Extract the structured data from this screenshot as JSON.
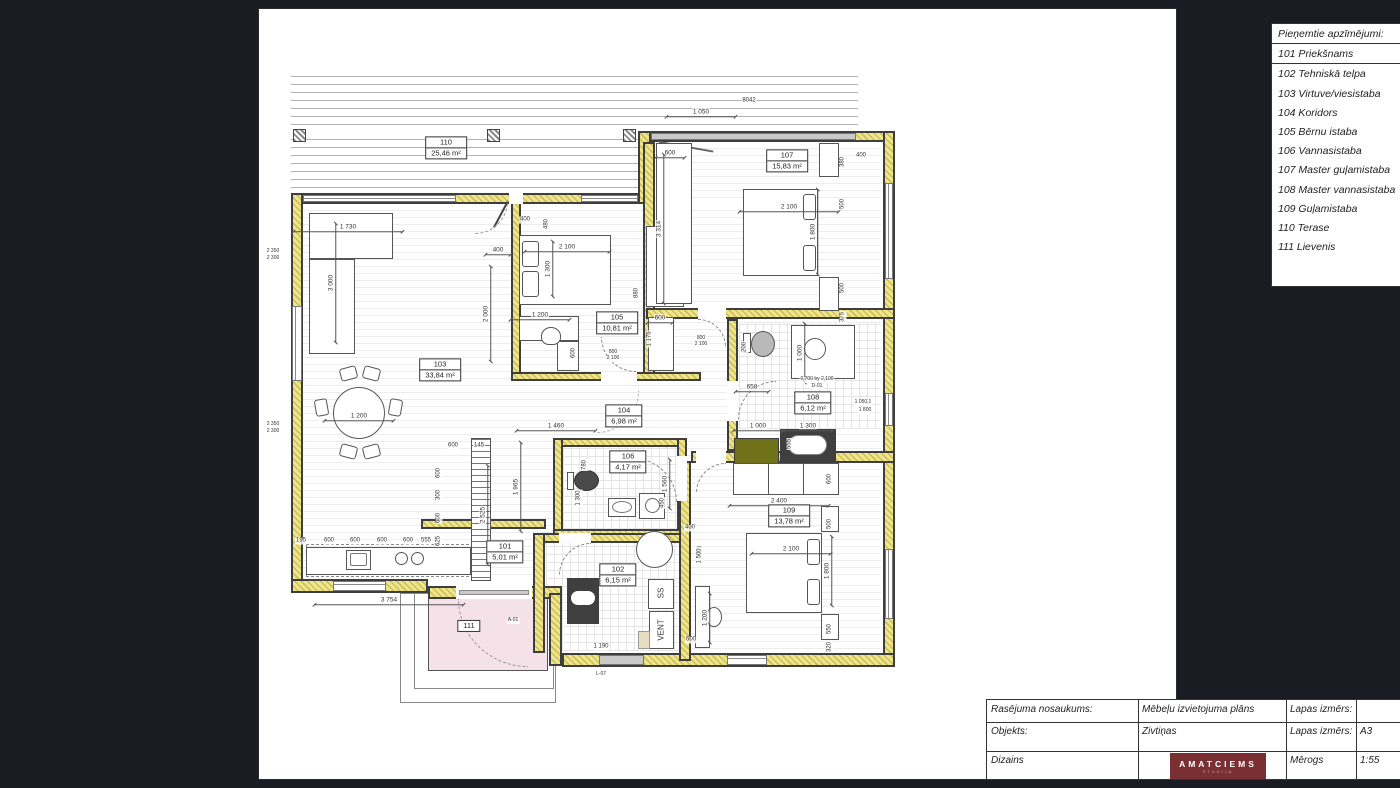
{
  "legend": {
    "title": "Pieņemtie apzīmējumi:",
    "items": [
      {
        "num": "101",
        "name": "Priekšnams"
      },
      {
        "num": "102",
        "name": "Tehniskā telpa"
      },
      {
        "num": "103",
        "name": "Virtuve/viesistaba"
      },
      {
        "num": "104",
        "name": "Koridors"
      },
      {
        "num": "105",
        "name": "Bērnu istaba"
      },
      {
        "num": "106",
        "name": "Vannasistaba"
      },
      {
        "num": "107",
        "name": "Master guļamistaba"
      },
      {
        "num": "108",
        "name": "Master vannasistaba"
      },
      {
        "num": "109",
        "name": "Guļamistaba"
      },
      {
        "num": "110",
        "name": "Terase"
      },
      {
        "num": "111",
        "name": "Lievenis"
      }
    ]
  },
  "title_block": {
    "rows": [
      {
        "label": "Rasējuma nosaukums:",
        "value": "Mēbeļu izvietojuma plāns",
        "label2": "Lapas izmērs:",
        "value2": ""
      },
      {
        "label": "Objekts:",
        "value": "Zivtiņas",
        "label2": "Lapas izmērs:",
        "value2": "A3"
      },
      {
        "label": "Dizains",
        "value": "",
        "label2": "Mērogs",
        "value2": "1:55"
      }
    ],
    "logo": {
      "text": "AMATCIEMS",
      "subtext": "STUDIJA"
    }
  },
  "plan": {
    "colors": {
      "insulation": "#efe58d",
      "wall": "#3e3e3e",
      "porch_pink": "#f5e1e8",
      "logo_maroon": "#7a2f33",
      "counter_dark": "#3f3f3f",
      "cabinet_olive": "#6f7218"
    },
    "rooms": [
      {
        "num": "110",
        "area": "25,46 m²",
        "x": 445,
        "y": 147
      },
      {
        "num": "103",
        "area": "33,84 m²",
        "x": 439,
        "y": 369
      },
      {
        "num": "105",
        "area": "10,81 m²",
        "x": 616,
        "y": 322
      },
      {
        "num": "107",
        "area": "15,83 m²",
        "x": 786,
        "y": 160
      },
      {
        "num": "104",
        "area": "6,98 m²",
        "x": 623,
        "y": 415
      },
      {
        "num": "106",
        "area": "4,17 m²",
        "x": 627,
        "y": 461
      },
      {
        "num": "108",
        "area": "6,12 m²",
        "x": 812,
        "y": 402
      },
      {
        "num": "101",
        "area": "5,01 m²",
        "x": 504,
        "y": 551
      },
      {
        "num": "102",
        "area": "6,15 m²",
        "x": 617,
        "y": 574
      },
      {
        "num": "109",
        "area": "13,78 m²",
        "x": 788,
        "y": 515
      },
      {
        "num": "111",
        "area": "",
        "x": 468,
        "y": 625
      }
    ],
    "dims": [
      {
        "t": "1 050",
        "x": 700,
        "y": 112,
        "w": 70
      },
      {
        "t": "8042",
        "x": 748,
        "y": 100,
        "s": 6
      },
      {
        "t": "600",
        "x": 669,
        "y": 153,
        "w": 30
      },
      {
        "t": "3 314",
        "x": 659,
        "y": 228,
        "r": -90,
        "w": 150
      },
      {
        "t": "2 100",
        "x": 788,
        "y": 207,
        "w": 100
      },
      {
        "t": "1 800",
        "x": 813,
        "y": 231,
        "r": -90,
        "w": 86
      },
      {
        "t": "380",
        "x": 842,
        "y": 161,
        "r": -90,
        "s": 6
      },
      {
        "t": "400",
        "x": 860,
        "y": 155,
        "s": 6
      },
      {
        "t": "500",
        "x": 842,
        "y": 203,
        "r": -90,
        "s": 6
      },
      {
        "t": "500",
        "x": 842,
        "y": 287,
        "r": -90,
        "s": 6
      },
      {
        "t": "375",
        "x": 842,
        "y": 316,
        "r": -90,
        "s": 6
      },
      {
        "t": "1 730",
        "x": 347,
        "y": 227,
        "w": 110
      },
      {
        "t": "3 000",
        "x": 331,
        "y": 282,
        "r": -90,
        "w": 120
      },
      {
        "t": "1 200",
        "x": 358,
        "y": 416,
        "w": 70
      },
      {
        "t": "400",
        "x": 497,
        "y": 250,
        "w": 26
      },
      {
        "t": "2 000",
        "x": 486,
        "y": 313,
        "r": -90,
        "w": 96
      },
      {
        "t": "400",
        "x": 524,
        "y": 219,
        "s": 6
      },
      {
        "t": "480",
        "x": 546,
        "y": 223,
        "r": -90,
        "s": 6
      },
      {
        "t": "2 100",
        "x": 566,
        "y": 247,
        "w": 86
      },
      {
        "t": "1 300",
        "x": 548,
        "y": 268,
        "r": -90,
        "w": 56
      },
      {
        "t": "1 200",
        "x": 539,
        "y": 315,
        "w": 60
      },
      {
        "t": "600",
        "x": 573,
        "y": 352,
        "r": -90,
        "s": 6
      },
      {
        "t": "880",
        "x": 636,
        "y": 292,
        "r": -90,
        "s": 6
      },
      {
        "t": "1 175",
        "x": 649,
        "y": 338,
        "r": -90,
        "s": 6
      },
      {
        "t": "600",
        "x": 659,
        "y": 318,
        "w": 26
      },
      {
        "t": "600",
        "x": 452,
        "y": 445,
        "s": 6
      },
      {
        "t": "145",
        "x": 478,
        "y": 445,
        "s": 6
      },
      {
        "t": "600",
        "x": 438,
        "y": 472,
        "r": -90,
        "s": 6
      },
      {
        "t": "300",
        "x": 438,
        "y": 494,
        "r": -90,
        "s": 6
      },
      {
        "t": "600",
        "x": 438,
        "y": 517,
        "r": -90,
        "s": 6
      },
      {
        "t": "625",
        "x": 438,
        "y": 540,
        "r": -90,
        "s": 6
      },
      {
        "t": "2 525",
        "x": 483,
        "y": 514,
        "r": -90,
        "w": 100
      },
      {
        "t": "1 965",
        "x": 516,
        "y": 486,
        "r": -90,
        "w": 90
      },
      {
        "t": "600",
        "x": 328,
        "y": 540,
        "s": 6
      },
      {
        "t": "600",
        "x": 354,
        "y": 540,
        "s": 6
      },
      {
        "t": "600",
        "x": 381,
        "y": 540,
        "s": 6
      },
      {
        "t": "600",
        "x": 407,
        "y": 540,
        "s": 6
      },
      {
        "t": "555",
        "x": 425,
        "y": 540,
        "s": 6
      },
      {
        "t": "195",
        "x": 300,
        "y": 540,
        "s": 6
      },
      {
        "t": "3 754",
        "x": 388,
        "y": 600,
        "w": 150
      },
      {
        "t": "1 460",
        "x": 555,
        "y": 426,
        "w": 80
      },
      {
        "t": "780",
        "x": 584,
        "y": 464,
        "r": -90,
        "s": 6
      },
      {
        "t": "1 300",
        "x": 578,
        "y": 497,
        "r": -90,
        "s": 6
      },
      {
        "t": "1 560",
        "x": 665,
        "y": 483,
        "r": -90,
        "w": 50
      },
      {
        "t": "450",
        "x": 662,
        "y": 502,
        "r": -90,
        "s": 6
      },
      {
        "t": "400",
        "x": 689,
        "y": 527,
        "s": 6
      },
      {
        "t": "500",
        "x": 700,
        "y": 550,
        "r": -90,
        "s": 6
      },
      {
        "t": "658",
        "x": 751,
        "y": 387,
        "w": 34
      },
      {
        "t": "200",
        "x": 744,
        "y": 346,
        "r": -90,
        "s": 6
      },
      {
        "t": "1 000",
        "x": 800,
        "y": 352,
        "r": -90,
        "w": 60
      },
      {
        "t": "1 000",
        "x": 757,
        "y": 426,
        "w": 50
      },
      {
        "t": "1 300",
        "x": 807,
        "y": 426,
        "w": 50
      },
      {
        "t": "555",
        "x": 789,
        "y": 443,
        "r": -90,
        "s": 6
      },
      {
        "t": "0,700 by 2,100",
        "x": 816,
        "y": 379,
        "s": 5
      },
      {
        "t": "D-01",
        "x": 816,
        "y": 386,
        "s": 5
      },
      {
        "t": "1 050,1",
        "x": 862,
        "y": 402,
        "s": 5
      },
      {
        "t": "1 800",
        "x": 864,
        "y": 410,
        "s": 5
      },
      {
        "t": "1 190",
        "x": 600,
        "y": 646,
        "s": 6
      },
      {
        "t": "L-07",
        "x": 600,
        "y": 674,
        "s": 5
      },
      {
        "t": "2 400",
        "x": 778,
        "y": 501,
        "w": 100
      },
      {
        "t": "600",
        "x": 829,
        "y": 478,
        "r": -90,
        "s": 6
      },
      {
        "t": "500",
        "x": 829,
        "y": 523,
        "r": -90,
        "s": 6
      },
      {
        "t": "2 100",
        "x": 790,
        "y": 549,
        "w": 80
      },
      {
        "t": "1 800",
        "x": 827,
        "y": 570,
        "r": -90,
        "w": 70
      },
      {
        "t": "550",
        "x": 829,
        "y": 628,
        "r": -90,
        "s": 6
      },
      {
        "t": "320",
        "x": 829,
        "y": 646,
        "r": -90,
        "s": 6
      },
      {
        "t": "1 200",
        "x": 705,
        "y": 617,
        "r": -90,
        "w": 50
      },
      {
        "t": "600",
        "x": 690,
        "y": 639,
        "s": 6
      },
      {
        "t": "1 500",
        "x": 699,
        "y": 555,
        "r": -90,
        "s": 6
      },
      {
        "t": "2 350",
        "x": 272,
        "y": 251,
        "s": 5
      },
      {
        "t": "2 300",
        "x": 272,
        "y": 258,
        "s": 5
      },
      {
        "t": "2 350",
        "x": 272,
        "y": 424,
        "s": 5
      },
      {
        "t": "2 300",
        "x": 272,
        "y": 431,
        "s": 5
      },
      {
        "t": "800",
        "x": 612,
        "y": 352,
        "s": 5
      },
      {
        "t": "2 100",
        "x": 612,
        "y": 358,
        "s": 5
      },
      {
        "t": "800",
        "x": 700,
        "y": 338,
        "s": 5
      },
      {
        "t": "2 100",
        "x": 700,
        "y": 344,
        "s": 5
      },
      {
        "t": "A-01",
        "x": 512,
        "y": 620,
        "s": 5
      },
      {
        "t": "SS",
        "x": 660,
        "y": 592,
        "r": -90,
        "s": 8
      },
      {
        "t": "VENT",
        "x": 660,
        "y": 629,
        "r": -90,
        "s": 8
      }
    ]
  }
}
